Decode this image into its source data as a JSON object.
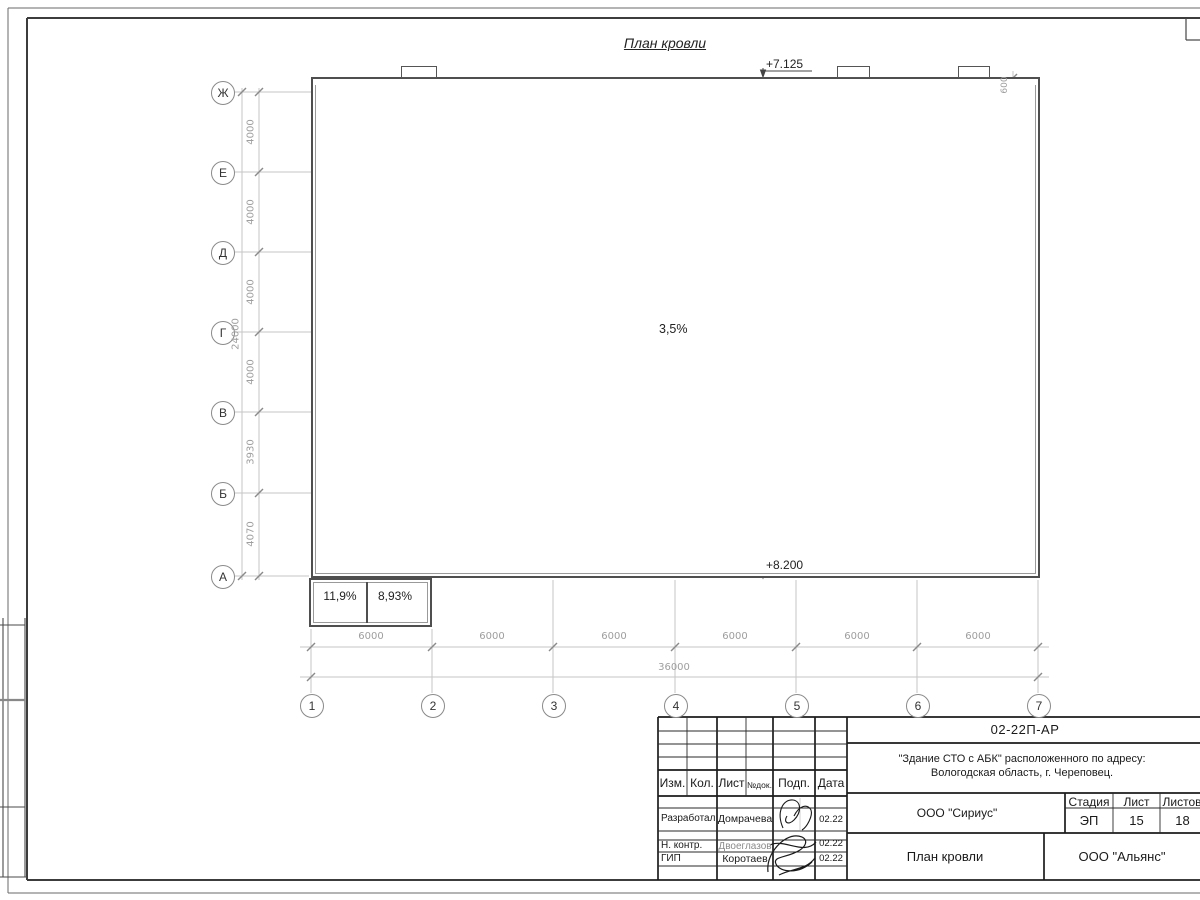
{
  "sheet": {
    "drawing_title": "План кровли"
  },
  "plan": {
    "elevation_top": "+7.125",
    "elevation_bottom": "+8.200",
    "slope_main": "3,5%",
    "parapet_offset_dim": "600",
    "annex": {
      "slope_left": "11,9%",
      "slope_right": "8,93%"
    }
  },
  "axes": {
    "rows": [
      {
        "label": "Ж"
      },
      {
        "label": "Е"
      },
      {
        "label": "Д"
      },
      {
        "label": "Г"
      },
      {
        "label": "В"
      },
      {
        "label": "Б"
      },
      {
        "label": "А"
      }
    ],
    "row_dims": [
      "4000",
      "4000",
      "4000",
      "4000",
      "3930",
      "4070"
    ],
    "row_total": "24000",
    "cols": [
      {
        "label": "1"
      },
      {
        "label": "2"
      },
      {
        "label": "3"
      },
      {
        "label": "4"
      },
      {
        "label": "5"
      },
      {
        "label": "6"
      },
      {
        "label": "7"
      }
    ],
    "col_dims": [
      "6000",
      "6000",
      "6000",
      "6000",
      "6000",
      "6000"
    ],
    "col_total": "36000"
  },
  "titleblock": {
    "doc_number": "02-22П-АР",
    "project_line1": "\"Здание СТО с АБК\" расположенного по адресу:",
    "project_line2": "Вологодская область, г. Череповец.",
    "designer_org": "ООО \"Сириус\"",
    "client_org": "ООО \"Альянс\"",
    "sheet_title": "План кровли",
    "stage_header": "Стадия",
    "sheet_header": "Лист",
    "sheets_header": "Листов",
    "stage_value": "ЭП",
    "sheet_value": "15",
    "sheets_value": "18",
    "columns": {
      "izm": "Изм.",
      "kol": "Кол.",
      "list": "Лист",
      "doc": "№док.",
      "sign": "Подп.",
      "date": "Дата"
    },
    "rows": [
      {
        "role": "Разработал",
        "name": "Домрачева",
        "date": "02.22"
      },
      {
        "role": "Н. контр.",
        "name": "Двоеглазов",
        "date": "02.22"
      },
      {
        "role": "ГИП",
        "name": "Коротаев",
        "date": "02.22"
      }
    ]
  }
}
